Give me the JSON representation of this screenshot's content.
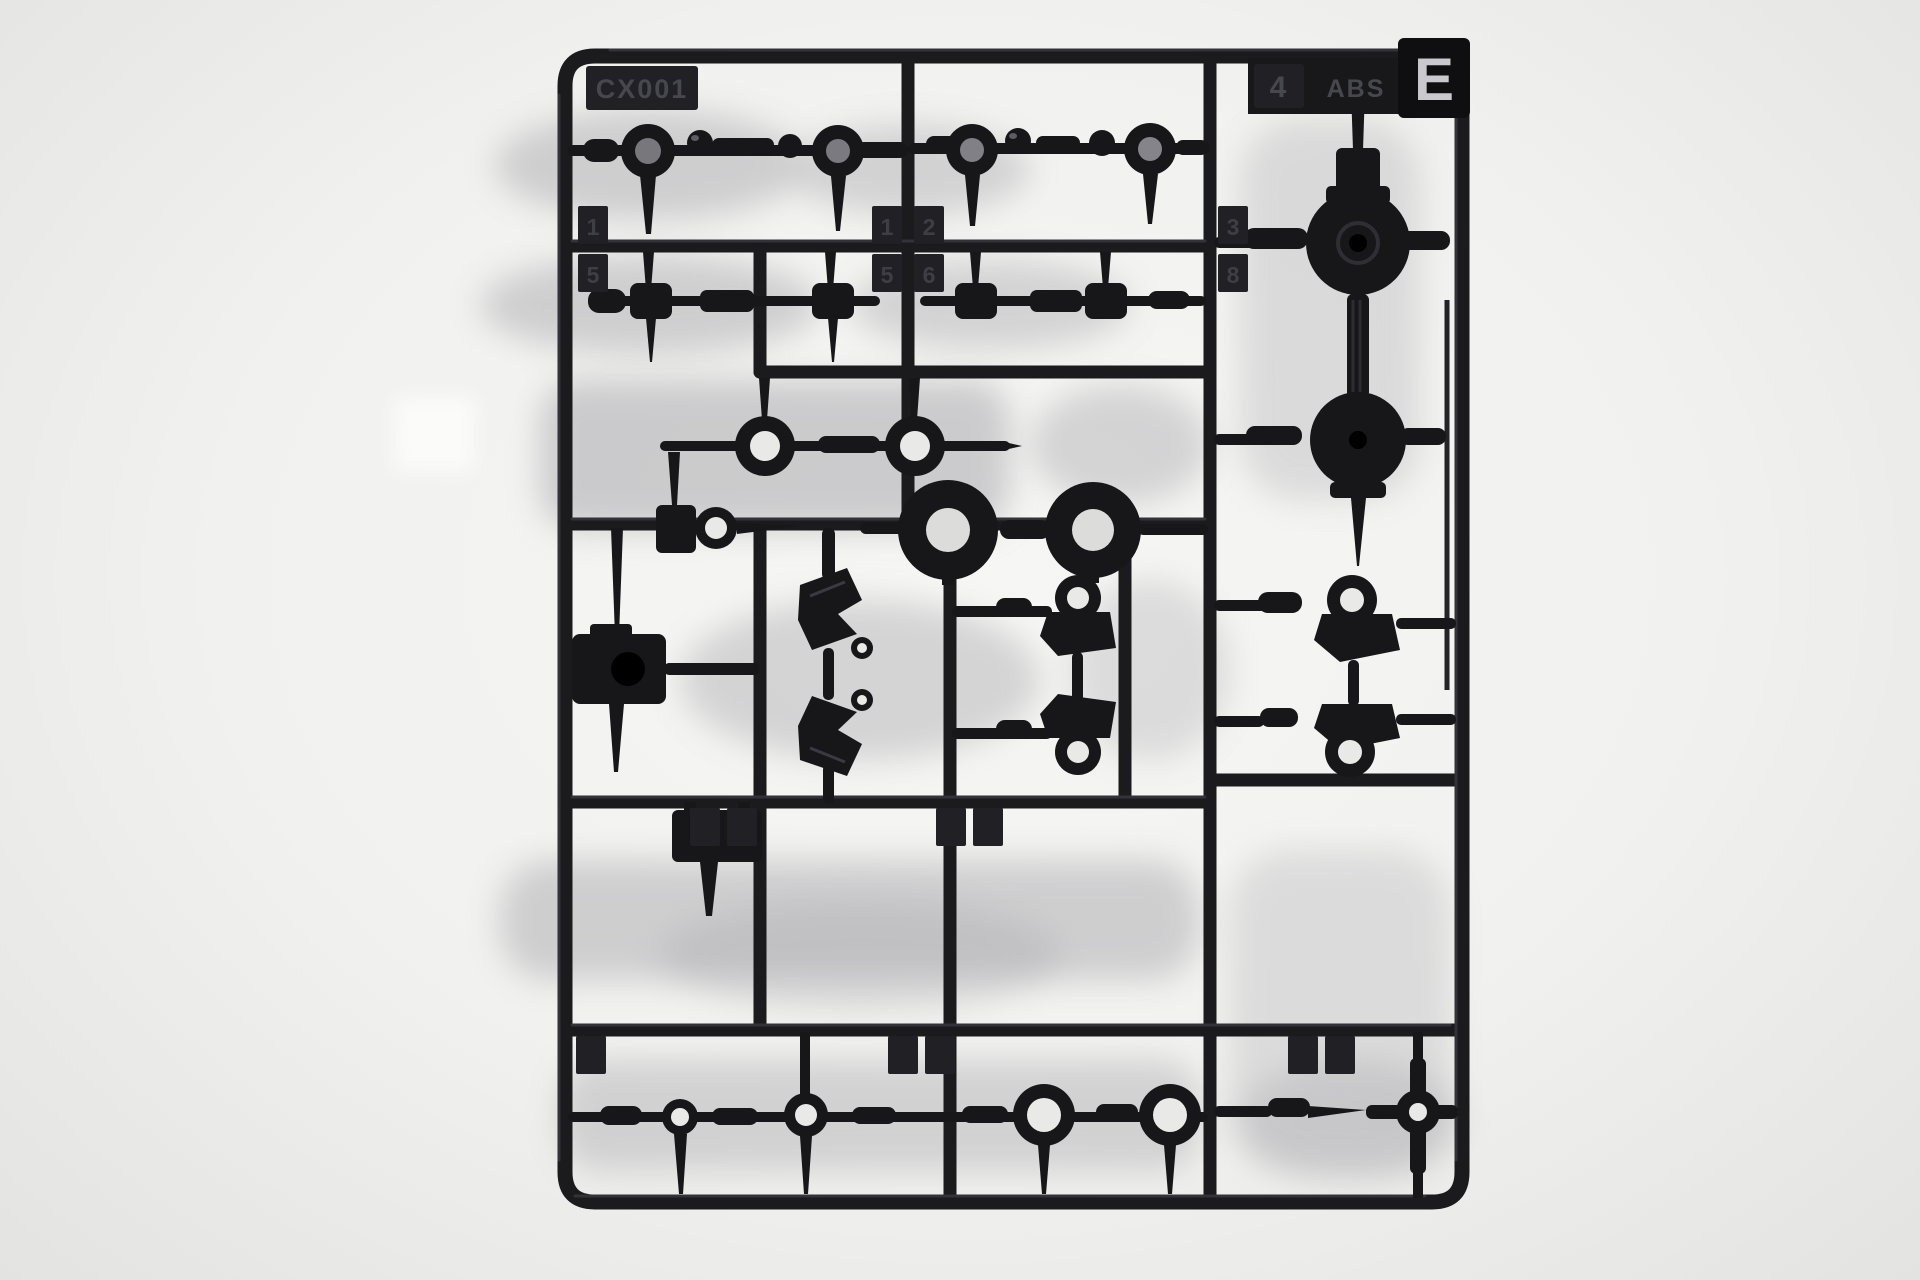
{
  "colors": {
    "background": "#f2f2f0",
    "plastic": "#1a1a1e",
    "plastic_highlight": "#4a4a52",
    "tag_emboss": "#3e3e45",
    "hole_light": "#e9e9e7",
    "hole_gray": "#77777c",
    "runner_letter_color": "#c9c9cd"
  },
  "markings": {
    "mold_code": "CX001",
    "mold_number": "4",
    "material": "ABS",
    "runner_letter": "E"
  },
  "tags": [
    {
      "label": "1",
      "x": 578,
      "y": 206
    },
    {
      "label": "5",
      "x": 578,
      "y": 254
    },
    {
      "label": "1",
      "x": 872,
      "y": 206
    },
    {
      "label": "2",
      "x": 914,
      "y": 206
    },
    {
      "label": "5",
      "x": 872,
      "y": 254
    },
    {
      "label": "6",
      "x": 914,
      "y": 254
    },
    {
      "label": "3",
      "x": 1218,
      "y": 206
    },
    {
      "label": "8",
      "x": 1218,
      "y": 254
    },
    {
      "label": "",
      "x": 690,
      "y": 808
    },
    {
      "label": "",
      "x": 727,
      "y": 808
    },
    {
      "label": "",
      "x": 936,
      "y": 808
    },
    {
      "label": "",
      "x": 973,
      "y": 808
    },
    {
      "label": "",
      "x": 576,
      "y": 1036
    },
    {
      "label": "",
      "x": 888,
      "y": 1036
    },
    {
      "label": "",
      "x": 925,
      "y": 1036
    },
    {
      "label": "",
      "x": 1288,
      "y": 1036
    },
    {
      "label": "",
      "x": 1325,
      "y": 1036
    }
  ]
}
